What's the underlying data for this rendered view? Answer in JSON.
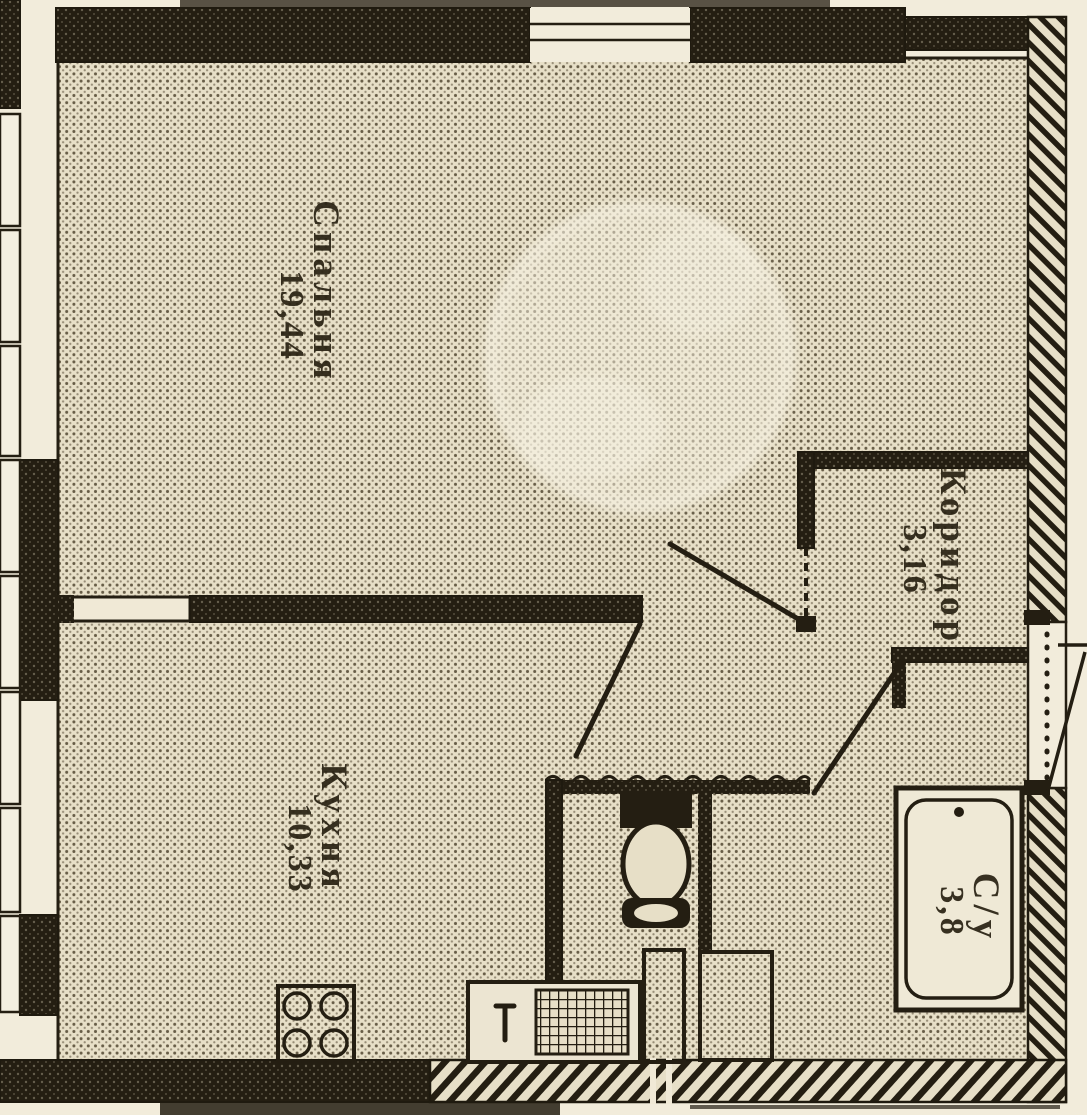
{
  "plan": {
    "rooms": {
      "bedroom": {
        "name": "Спальня",
        "area": "19,44"
      },
      "kitchen": {
        "name": "Кухня",
        "area": "10,33"
      },
      "corridor": {
        "name": "Коридор",
        "area": "3,16"
      },
      "bathroom": {
        "name": "С/у",
        "area": "3,8"
      }
    },
    "symbols": {
      "stove": "stove-burners-symbol",
      "sink": "kitchen-sink-symbol",
      "toilet": "toilet-symbol",
      "bathtub": "bathtub-symbol",
      "washing_machine": "washing-machine-symbol",
      "doors": "door-swing-symbol",
      "windows": "window-symbol",
      "watermark": "circular-watermark"
    },
    "colors": {
      "paper": "#e7dfc7",
      "outside": "#f2ecdb",
      "ink": "#241e12",
      "text_ink": "#2a2314"
    }
  }
}
